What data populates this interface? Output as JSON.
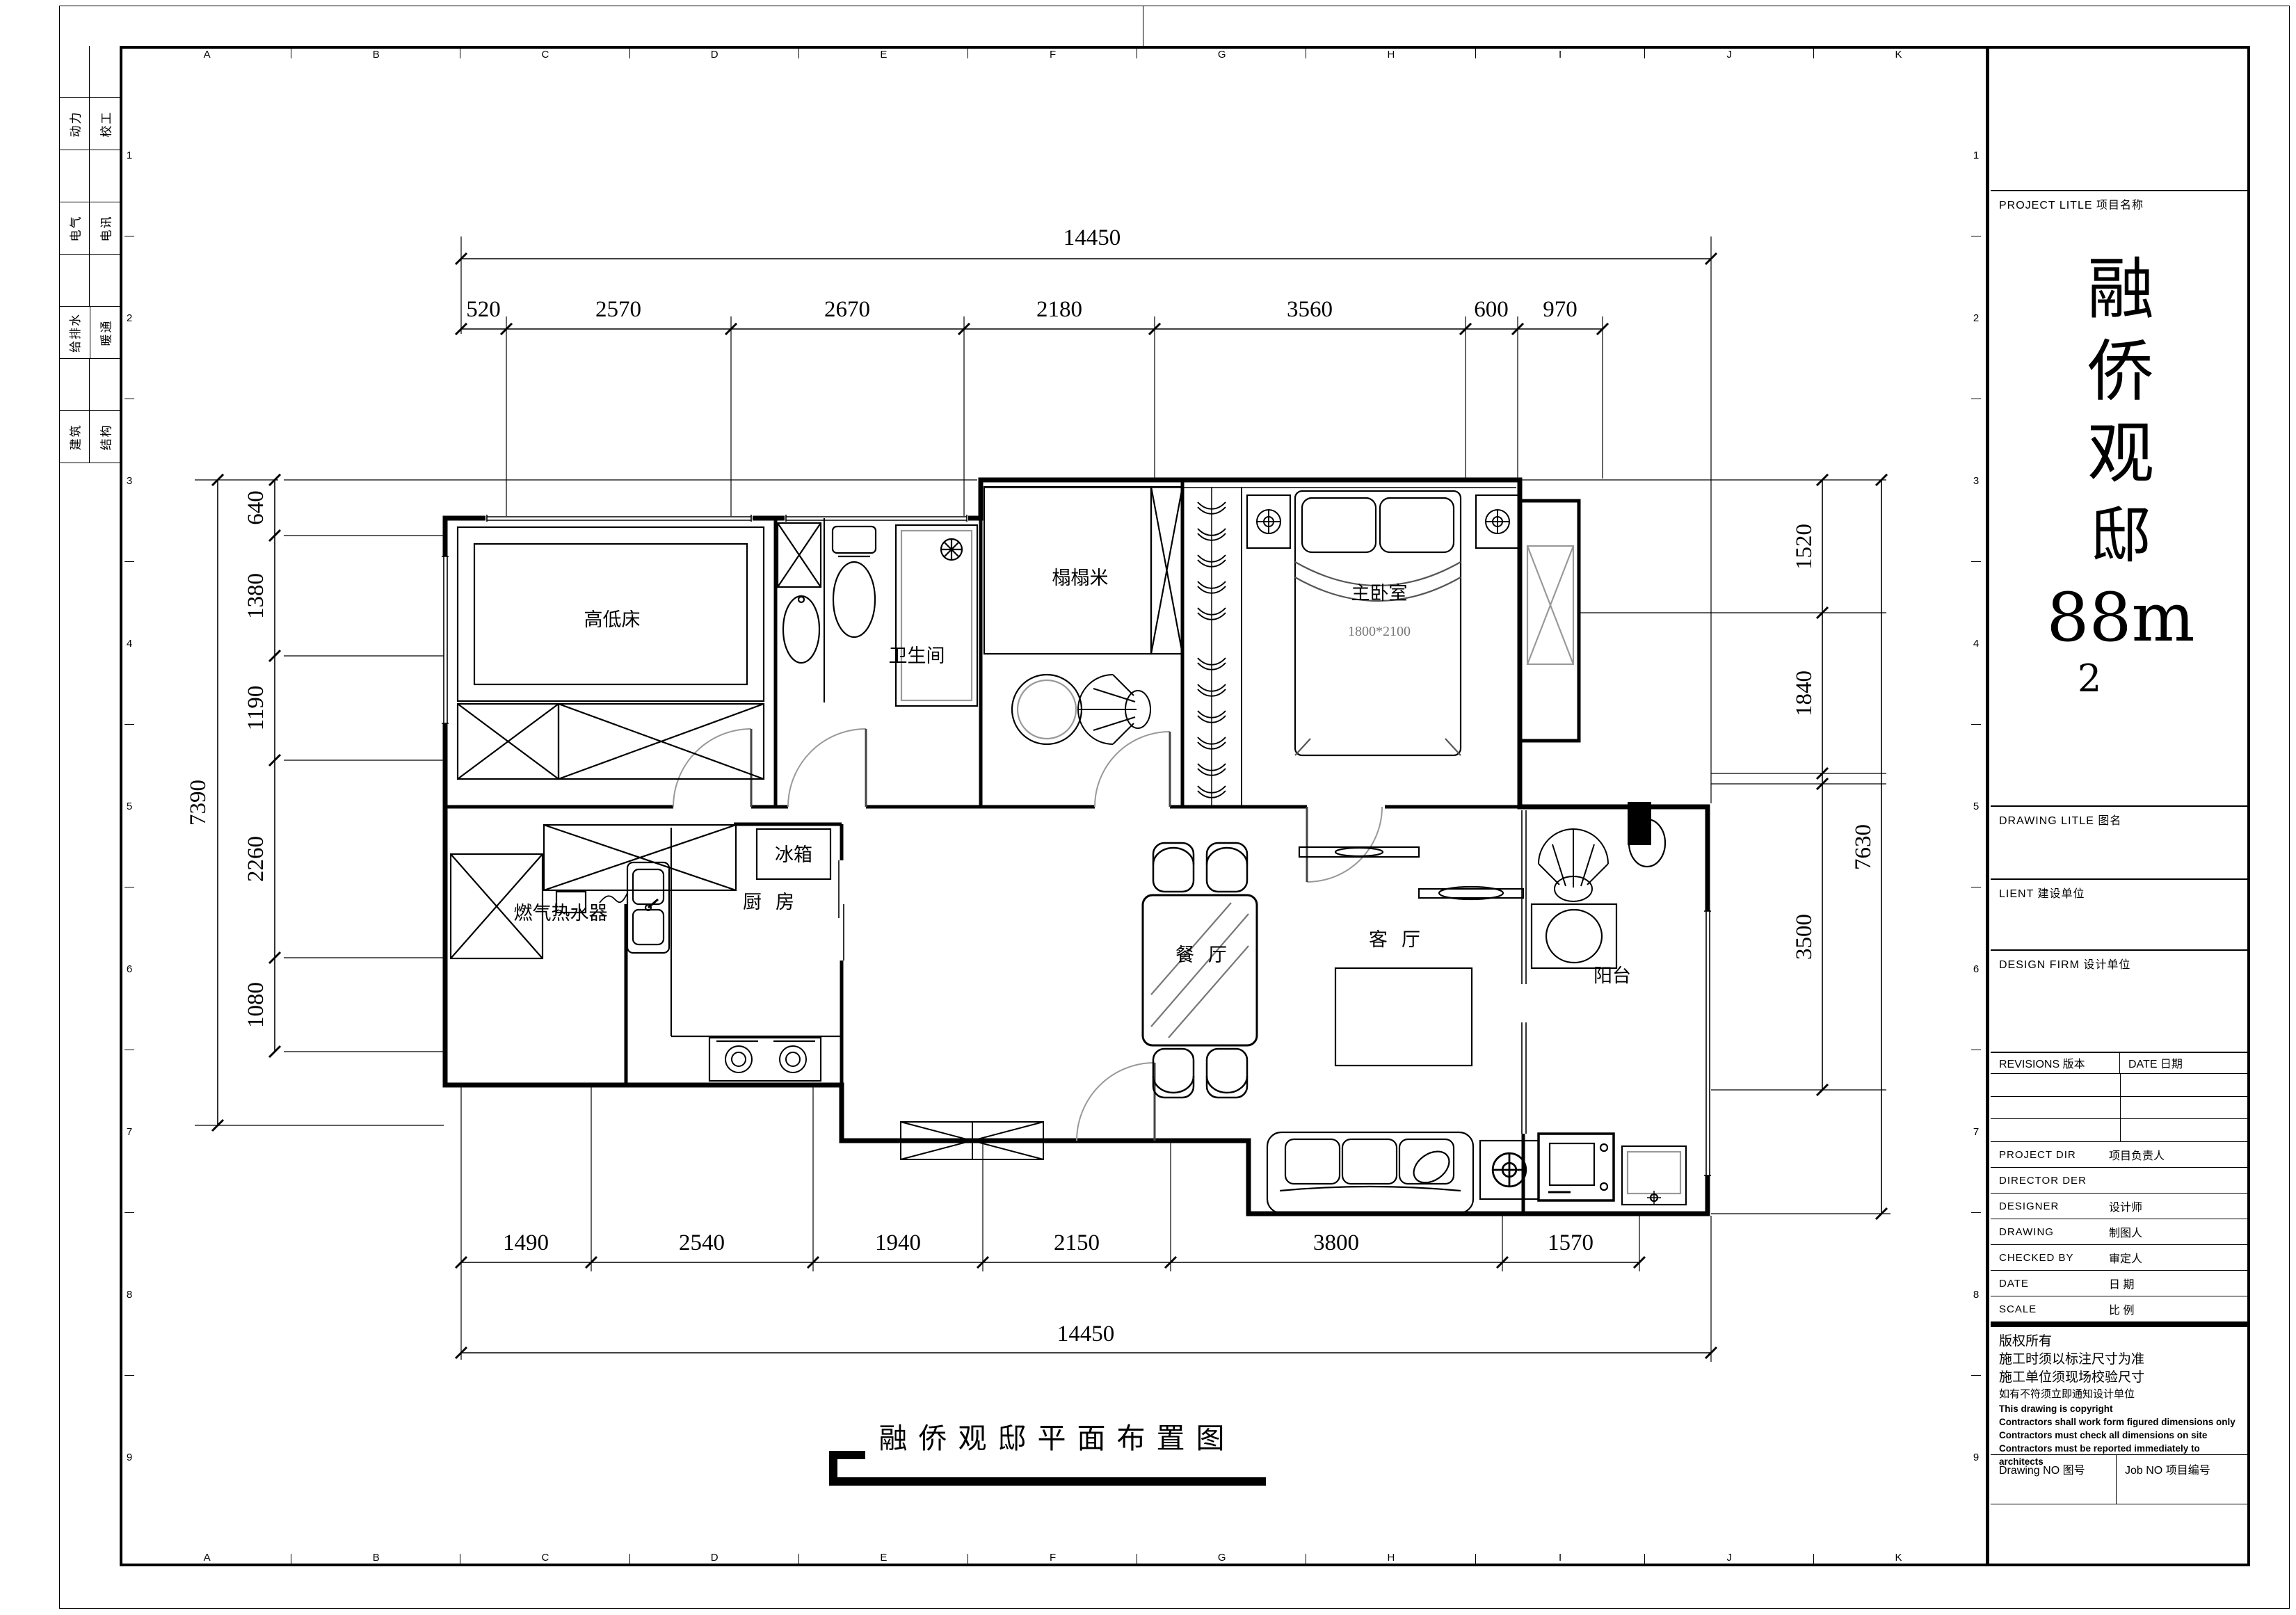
{
  "sheet": {
    "grid_letters": [
      "A",
      "B",
      "C",
      "D",
      "E",
      "F",
      "G",
      "H",
      "I",
      "J",
      "K"
    ],
    "grid_numbers": [
      "1",
      "2",
      "3",
      "4",
      "5",
      "6",
      "7",
      "8",
      "9"
    ],
    "discipline_cells": [
      {
        "l": "",
        "r": ""
      },
      {
        "l": "动力",
        "r": "校工"
      },
      {
        "l": "",
        "r": ""
      },
      {
        "l": "电气",
        "r": "电讯"
      },
      {
        "l": "",
        "r": ""
      },
      {
        "l": "给排水",
        "r": "暖通"
      },
      {
        "l": "",
        "r": ""
      },
      {
        "l": "建筑",
        "r": "结构"
      }
    ]
  },
  "plan": {
    "caption": "融侨观邸平面布置图",
    "rooms": {
      "child_room": "高低床",
      "bathroom": "卫生间",
      "tatami": "榻榻米",
      "master": "主卧室",
      "bed_size": "1800*2100",
      "dining": "餐厅",
      "kitchen": "厨房",
      "fridge": "冰箱",
      "living": "客厅",
      "balcony": "阳台",
      "gas_heater": "燃气热水器"
    },
    "dims": {
      "top_overall": "14450",
      "top": [
        "520",
        "2570",
        "2670",
        "2180",
        "3560",
        "600",
        "970"
      ],
      "bottom": [
        "1490",
        "2540",
        "1940",
        "2150",
        "3800",
        "1570"
      ],
      "bottom_overall": "14450",
      "left_overall": "7390",
      "left": [
        "640",
        "1380",
        "1190",
        "2260",
        "1080"
      ],
      "right": [
        "1520",
        "1840",
        "3500"
      ],
      "right_overall": "7630"
    }
  },
  "titleblock": {
    "project_label": "PROJECT LITLE  项目名称",
    "title_chars": [
      "融",
      "侨",
      "观",
      "邸",
      "88m",
      "2"
    ],
    "drawing_label": "DRAWING LITLE  图名",
    "client_label": "LIENT  建设单位",
    "firm_label": "DESIGN FIRM  设计单位",
    "revisions_label": "REVISIONS  版本",
    "date_label": "DATE  日期",
    "rows": [
      {
        "en": "PROJECT DIR",
        "cn": "项目负责人"
      },
      {
        "en": "DIRECTOR DER",
        "cn": ""
      },
      {
        "en": "DESIGNER",
        "cn": "设计师"
      },
      {
        "en": "DRAWING",
        "cn": "制图人"
      },
      {
        "en": "CHECKED BY",
        "cn": "审定人"
      },
      {
        "en": "DATE",
        "cn": "日  期"
      },
      {
        "en": "SCALE",
        "cn": "比  例"
      }
    ],
    "copyright_lines": [
      "版权所有",
      "施工时须以标注尺寸为准",
      "施工单位须现场校验尺寸",
      "如有不符须立即通知设计单位",
      "This drawing is copyright",
      "Contractors shall work form figured dimensions only",
      "Contractors must check all dimensions on site",
      "Contractors must be reported immediately to architects"
    ],
    "drawing_no_label": "Drawing NO  图号",
    "job_no_label": "Job NO  项目编号"
  }
}
